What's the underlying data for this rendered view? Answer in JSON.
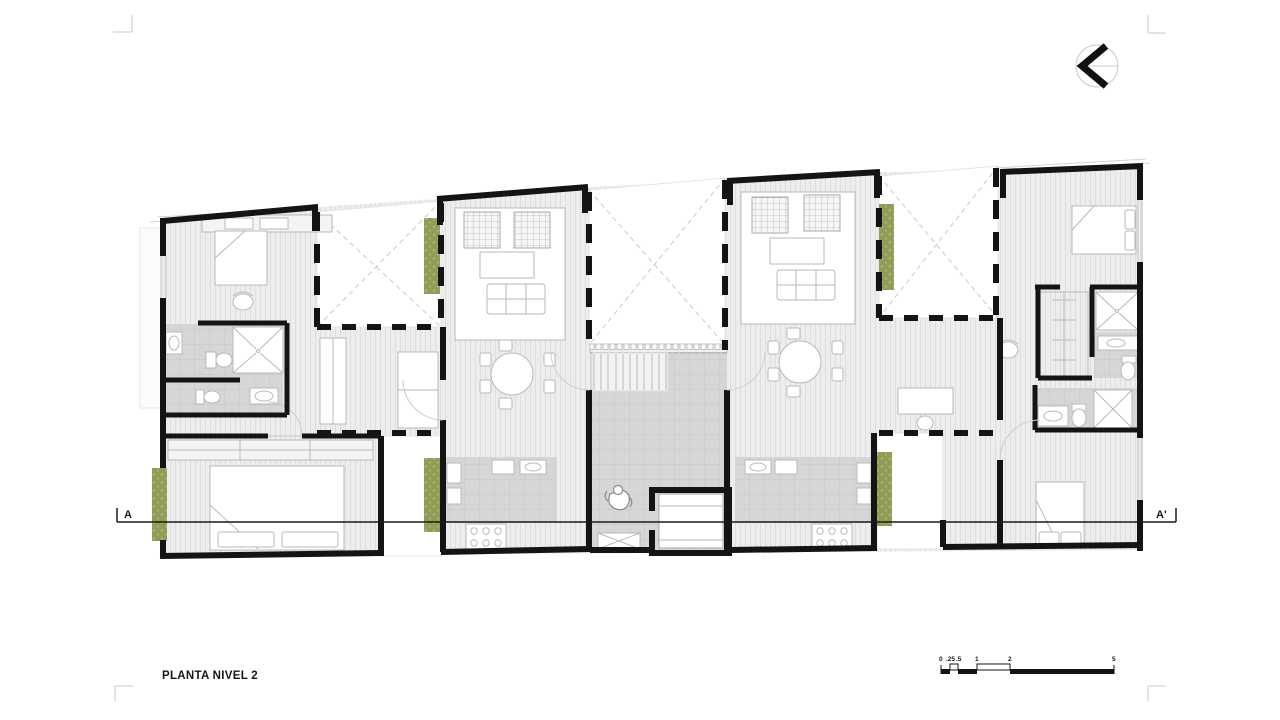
{
  "drawing": {
    "title": "PLANTA NIVEL 2",
    "section": {
      "start_label": "A",
      "end_label": "A'"
    },
    "scale_bar": {
      "labels": [
        "0",
        ".25",
        ".5",
        "1",
        "2",
        "5"
      ]
    }
  },
  "colors": {
    "wall": "#141414",
    "floor": "#ededed",
    "floorstripe": "#dedede",
    "tile": "#d6d6d6",
    "tileline": "#c8c8c8",
    "planter": "#8f9d57",
    "planterdot": "#abb877",
    "furniture": "#b9b9b9",
    "voidline": "#c9c9c9",
    "roof": "#d3d3d3",
    "mark": "#dcdcdc",
    "section": "#1a1a1a",
    "text": "#161616"
  }
}
